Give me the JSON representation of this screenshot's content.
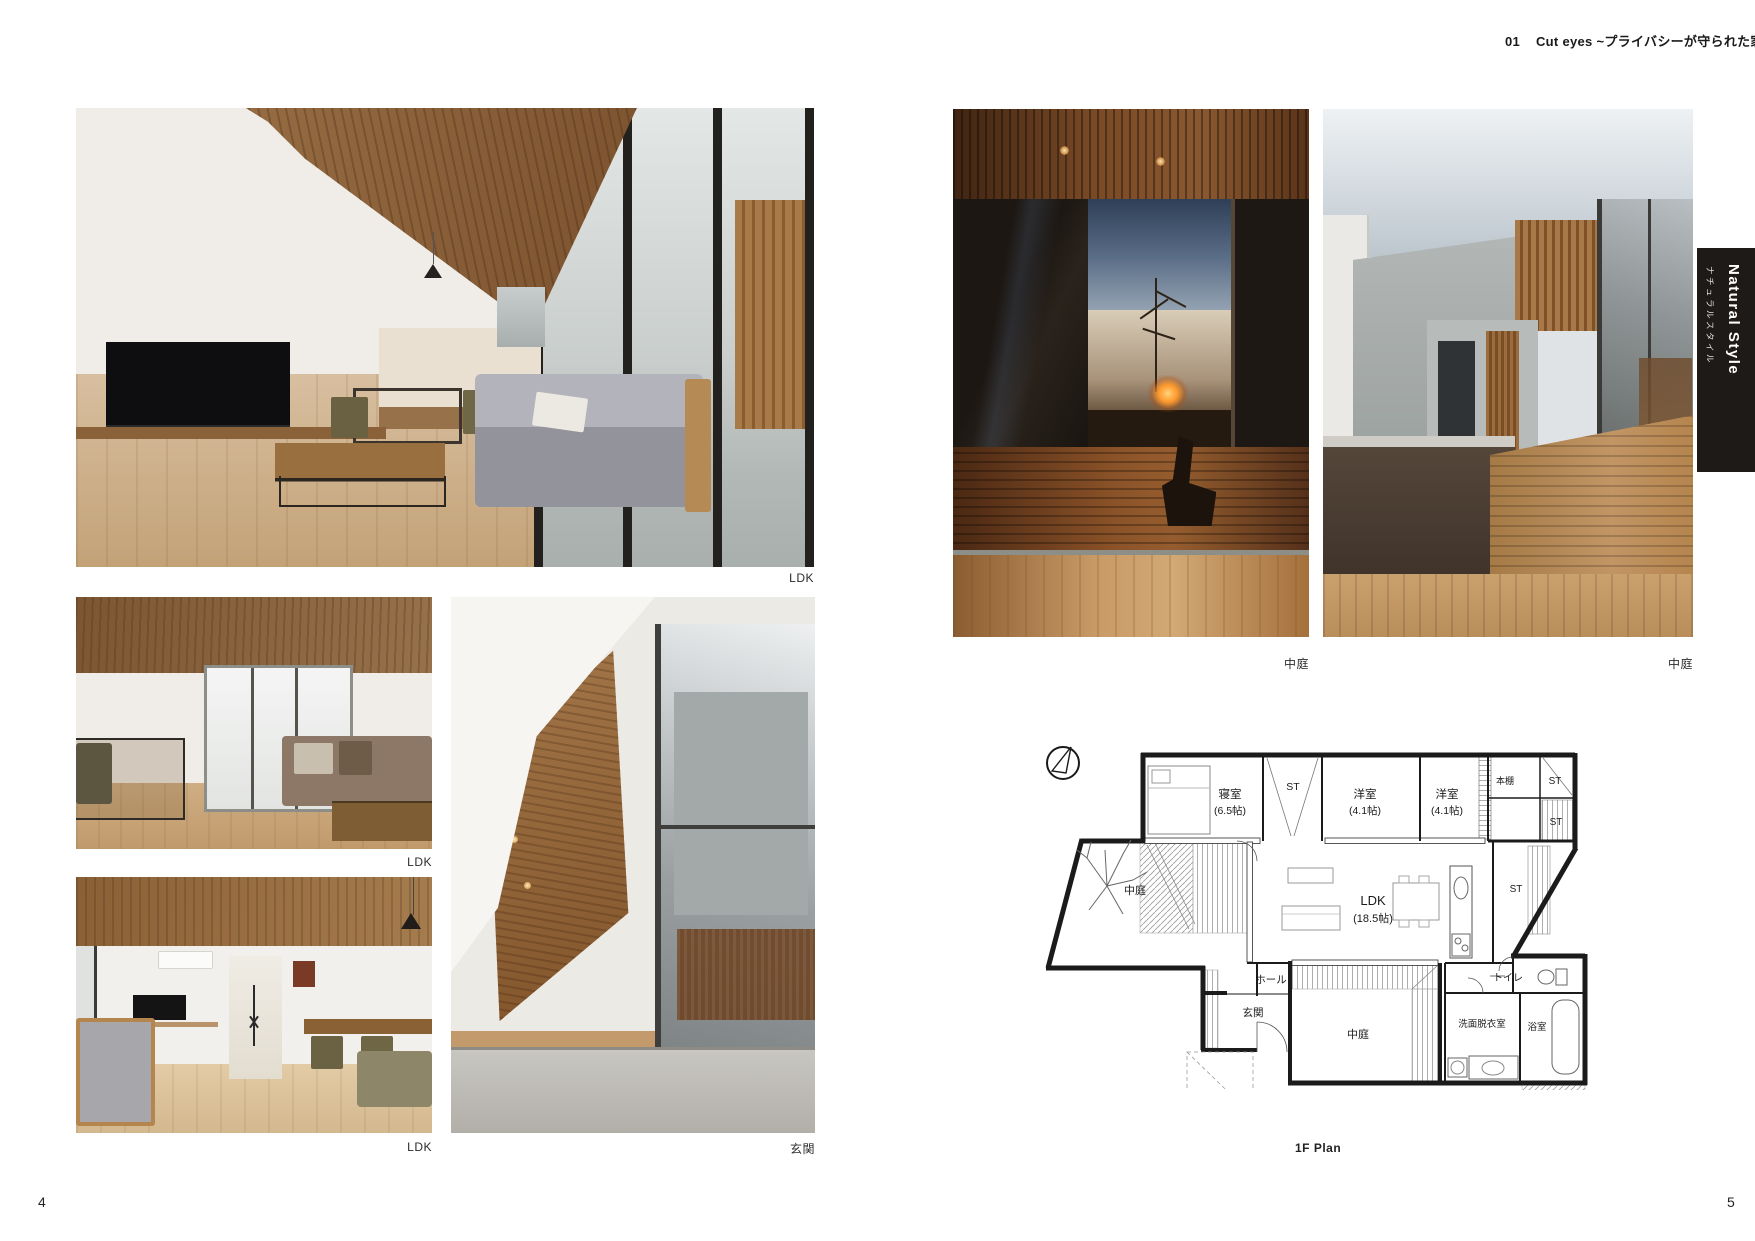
{
  "page": {
    "header_no": "01",
    "header_title": "Cut eyes ~プライバシーが守られた家~",
    "page_number_left": "4",
    "page_number_right": "5"
  },
  "side_tab": {
    "title_en": "Natural Style",
    "title_jp": "ナチュラルスタイル",
    "bg_color": "#1d1a17"
  },
  "photos": [
    {
      "caption": "LDK"
    },
    {
      "caption": "LDK"
    },
    {
      "caption": "LDK"
    },
    {
      "caption": "玄関"
    },
    {
      "caption": "中庭"
    },
    {
      "caption": "中庭"
    }
  ],
  "floor_plan": {
    "caption": "1F Plan",
    "labels": {
      "bedroom": "寝室",
      "bedroom_size": "(6.5帖)",
      "closet_st": "ST",
      "room1": "洋室",
      "room1_size": "(4.1帖)",
      "room2": "洋室",
      "room2_size": "(4.1帖)",
      "bookshelf": "本棚",
      "st_top_right": "ST",
      "st_right_mid": "ST",
      "st_right_lower": "ST",
      "courtyard_left": "中庭",
      "ldk": "LDK",
      "ldk_size": "(18.5帖)",
      "hall": "ホール",
      "entrance": "玄関",
      "courtyard_bottom": "中庭",
      "toilet": "トイレ",
      "washroom": "洗面脱衣室",
      "bathroom": "浴室"
    }
  }
}
